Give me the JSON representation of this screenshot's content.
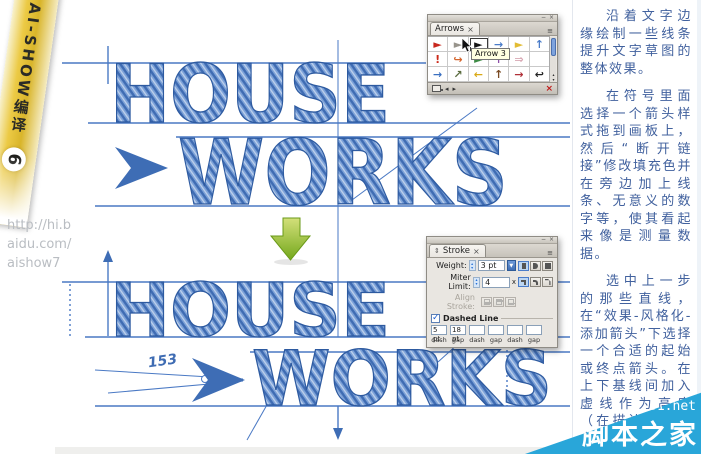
{
  "canvas": {
    "word_house": "HOUSE",
    "word_works": "WORKS",
    "measure_number": "153",
    "ink_color": "#3f6cb3",
    "guide_color": "#4a79c4",
    "green_arrow_color": "#7fb322"
  },
  "ribbon": {
    "title": "AI-SHOW编译",
    "number": "6",
    "url_lines": [
      "http://hi.b",
      "aidu.com/",
      "aishow7"
    ]
  },
  "arrows_panel": {
    "tab_label": "Arrows",
    "tab_close": "×",
    "window_minimize": "−",
    "window_close": "×",
    "menu_icon": "≡",
    "tooltip": "Arrow 3",
    "nav_prev": "◂",
    "nav_next": "▸",
    "delete_icon": "×",
    "scroll_up": "▴",
    "scroll_down": "▾",
    "symbols": [
      {
        "glyph": "►",
        "color": "#c8281e",
        "selected": false
      },
      {
        "glyph": "►",
        "color": "#98948c",
        "selected": false
      },
      {
        "glyph": "►",
        "color": "#141414",
        "selected": true
      },
      {
        "glyph": "→",
        "color": "#4a7cc9",
        "selected": false
      },
      {
        "glyph": "►",
        "color": "#e2bc34",
        "selected": false
      },
      {
        "glyph": "↑",
        "color": "#4a7cc9",
        "selected": false
      },
      {
        "glyph": "!",
        "color": "#cc2a1a",
        "selected": false
      },
      {
        "glyph": "↪",
        "color": "#d4652e",
        "selected": false
      },
      {
        "glyph": "►",
        "color": "#3d8b45",
        "selected": false
      },
      {
        "glyph": "↑",
        "color": "#8e4fa8",
        "selected": false
      },
      {
        "glyph": "⇒",
        "color": "#d8a8b4",
        "selected": false
      },
      {
        "glyph": "",
        "color": "#ffffff",
        "selected": false
      },
      {
        "glyph": "→",
        "color": "#3a6fc0",
        "selected": false
      },
      {
        "glyph": "↗",
        "color": "#5a6b3e",
        "selected": false
      },
      {
        "glyph": "←",
        "color": "#d9a916",
        "selected": false
      },
      {
        "glyph": "↑",
        "color": "#7a4a22",
        "selected": false
      },
      {
        "glyph": "→",
        "color": "#b03038",
        "selected": false
      },
      {
        "glyph": "↩",
        "color": "#222222",
        "selected": false
      }
    ]
  },
  "stroke_panel": {
    "tab_label": "Stroke",
    "tab_close": "×",
    "collapse_icon": "⇕",
    "window_minimize": "−",
    "window_close": "×",
    "menu_icon": "≡",
    "weight_label": "Weight:",
    "weight_value": "3 pt",
    "miter_label": "Miter Limit:",
    "miter_value": "4",
    "miter_unit": "x",
    "align_label": "Align Stroke:",
    "dashed_label": "Dashed Line",
    "check_icon": "✓",
    "stepper_up": "▴",
    "stepper_down": "▾",
    "dropdown_icon": "▼",
    "dash_fields": [
      "5 pt",
      "18 pt",
      "",
      "",
      "",
      ""
    ],
    "dash_labels": [
      "dash",
      "gap",
      "dash",
      "gap",
      "dash",
      "gap"
    ]
  },
  "sidebar": {
    "text_color": "#41619e",
    "paragraphs": [
      "沿着文字边缘绘制一些线条提升文字草图的整体效果。",
      "在符号里面选择一个箭头样式拖到画板上，然后“断开链接”修改填充色并在旁边加上线条、无意义的数字等，使其看起来像是测量数据。",
      "选中上一步的那些直线，在“效果-风格化-添加箭头”下选择一个合适的起始或终点箭头。在上下基线间加入虚线作为高度（在描边下勾选虚线，填入数值，生"
    ]
  },
  "watermark": {
    "site": "jb51.net",
    "name": "脚本之家",
    "color": "#29a6d9"
  }
}
